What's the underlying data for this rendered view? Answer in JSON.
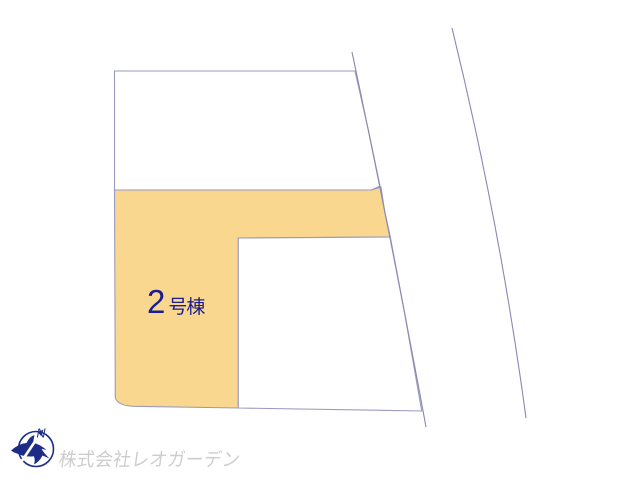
{
  "canvas": {
    "width": 640,
    "height": 480,
    "background": "#ffffff",
    "parcel_border_color": "#9a9ac0",
    "road_line_color": "#8888b2"
  },
  "plan": {
    "featured_parcel": {
      "label": "2号棟",
      "label_number": "2",
      "label_suffix": "号棟",
      "fill": "#f9d78f",
      "label_color": "#1c1c8f"
    },
    "upper_parcel": {
      "fill": "#ffffff"
    },
    "inner_parcel": {
      "fill": "#ffffff"
    }
  },
  "footer": {
    "company_name": "株式会社レオガーデン",
    "watermark_color": "#cdcdcd",
    "compass": {
      "north_label": "N",
      "color": "#1d2d87"
    }
  }
}
